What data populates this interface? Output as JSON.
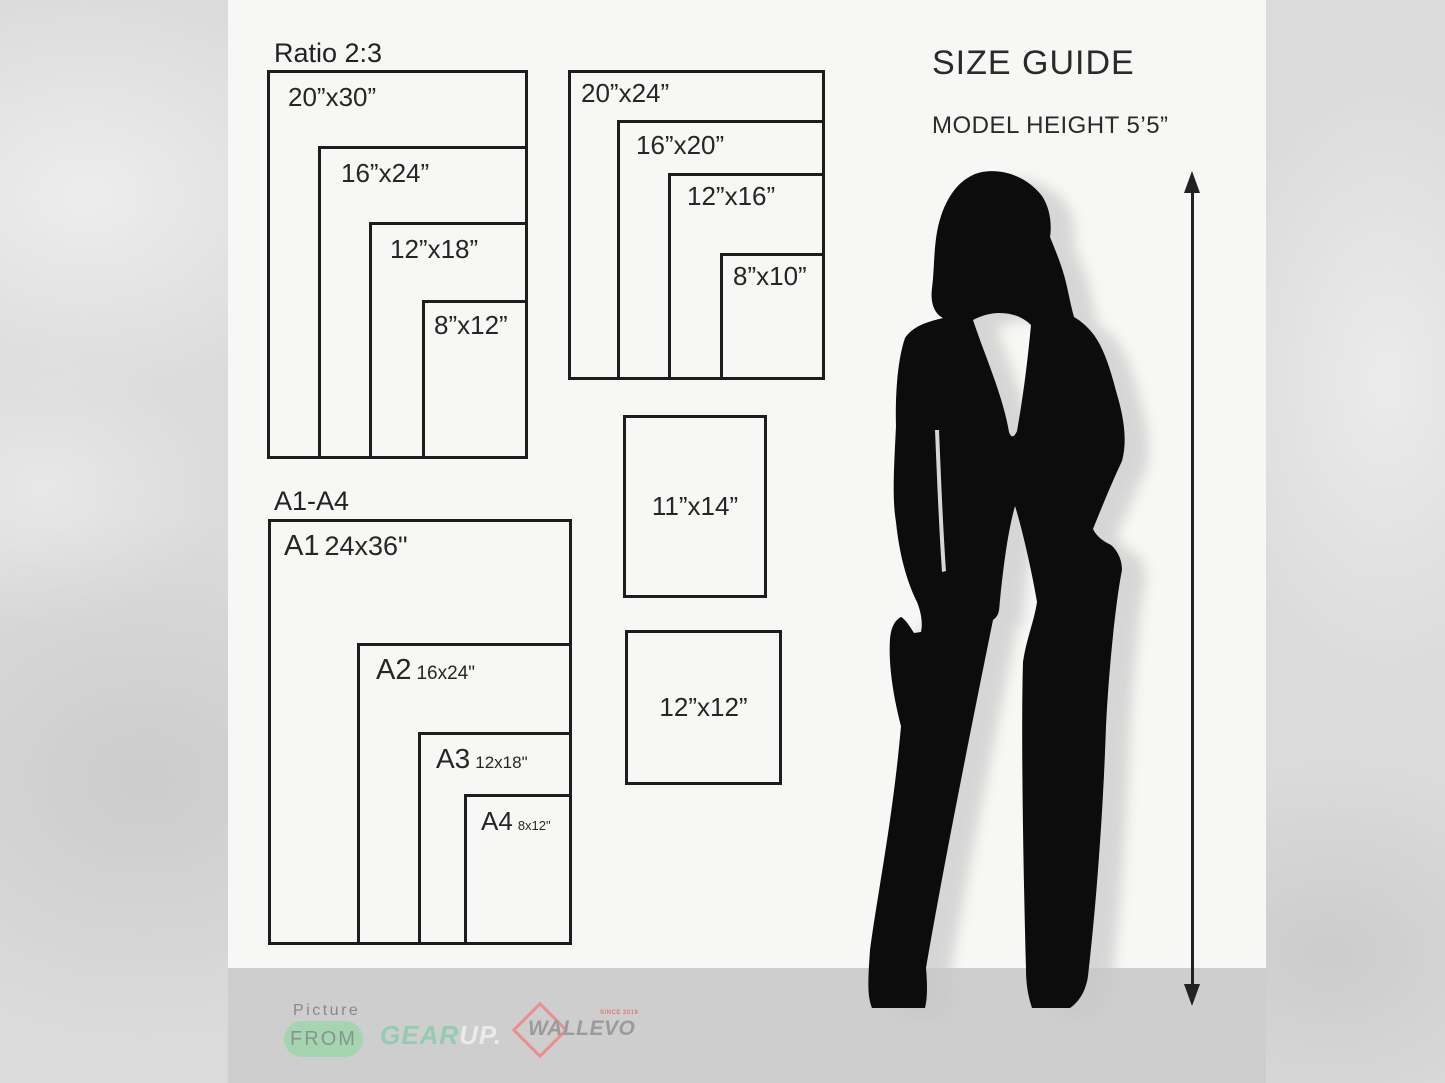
{
  "size_guide": {
    "title": "SIZE GUIDE",
    "model_height": "MODEL HEIGHT 5’5”"
  },
  "ratio_group": {
    "title": "Ratio 2:3",
    "sizes": [
      "20”x30”",
      "16”x24”",
      "12”x18”",
      "8”x12”"
    ]
  },
  "standard_group": {
    "sizes": [
      "20”x24”",
      "16”x20”",
      "12”x16”",
      "8”x10”"
    ]
  },
  "single_sizes": [
    "11”x14”",
    "12”x12”"
  ],
  "a_series_group": {
    "title": "A1-A4",
    "items": [
      {
        "code": "A1",
        "size": "24x36\""
      },
      {
        "code": "A2",
        "size": "16x24\""
      },
      {
        "code": "A3",
        "size": "12x18\""
      },
      {
        "code": "A4",
        "size": "8x12\""
      }
    ]
  },
  "footer": {
    "picture_label": "Picture",
    "from_badge": "FROM",
    "gearup": {
      "gear": "GEAR",
      "up": "UP."
    },
    "wallevo": {
      "name": "WALLEVO",
      "since": "SINCE 2019"
    }
  },
  "colors": {
    "ink": "#1d1d1d",
    "card_bg": "#f7f7f5",
    "strip_bg": "#cecece",
    "accent_green": "#a5d5b0",
    "accent_mint": "#92ccb2",
    "accent_red": "#ec8e8e"
  }
}
